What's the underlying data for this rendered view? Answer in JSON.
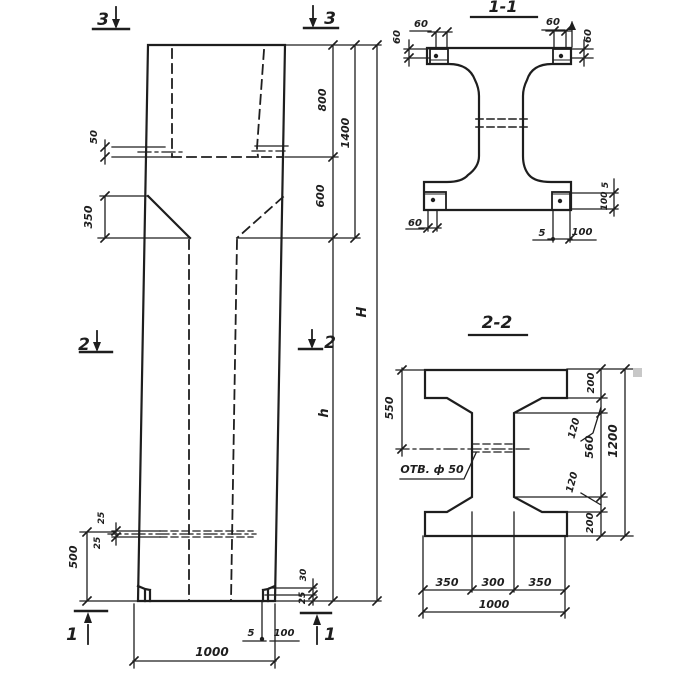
{
  "colors": {
    "ink": "#1e1e1e",
    "paper": "#ffffff",
    "artifact": "#c8c8c8"
  },
  "elevation": {
    "marks": {
      "tl3": "3",
      "tr3": "3",
      "ml2": "2",
      "mr2": "2",
      "bl1": "1",
      "br1": "1"
    },
    "dims": {
      "plate": "50",
      "taper": "350",
      "hole_top": "25",
      "hole_bot": "25",
      "base": "500",
      "foot_h": "30",
      "foot_c": "25",
      "gap": "5",
      "plate_w": "100",
      "width": "1000",
      "head_top": "800",
      "head_bot": "600",
      "head": "1400",
      "total": "H",
      "shaft": "h"
    }
  },
  "section11": {
    "title": "1-1",
    "dims": {
      "d60_tl": "60",
      "d60_tl_side": "60",
      "d60_tr": "60",
      "d60_tr_side": "60",
      "d60_bl": "60",
      "d5_side": "5",
      "d100_side": "100",
      "d5_bot": "5",
      "d100_bot": "100"
    }
  },
  "section22": {
    "title": "2-2",
    "hole": "ОТВ. ф 50",
    "dims": {
      "d550": "550",
      "d200_top": "200",
      "d120_top": "120",
      "d560": "560",
      "d120_bot": "120",
      "d200_bot": "200",
      "d1200": "1200",
      "d350_l": "350",
      "d300": "300",
      "d350_r": "350",
      "d1000": "1000"
    }
  }
}
